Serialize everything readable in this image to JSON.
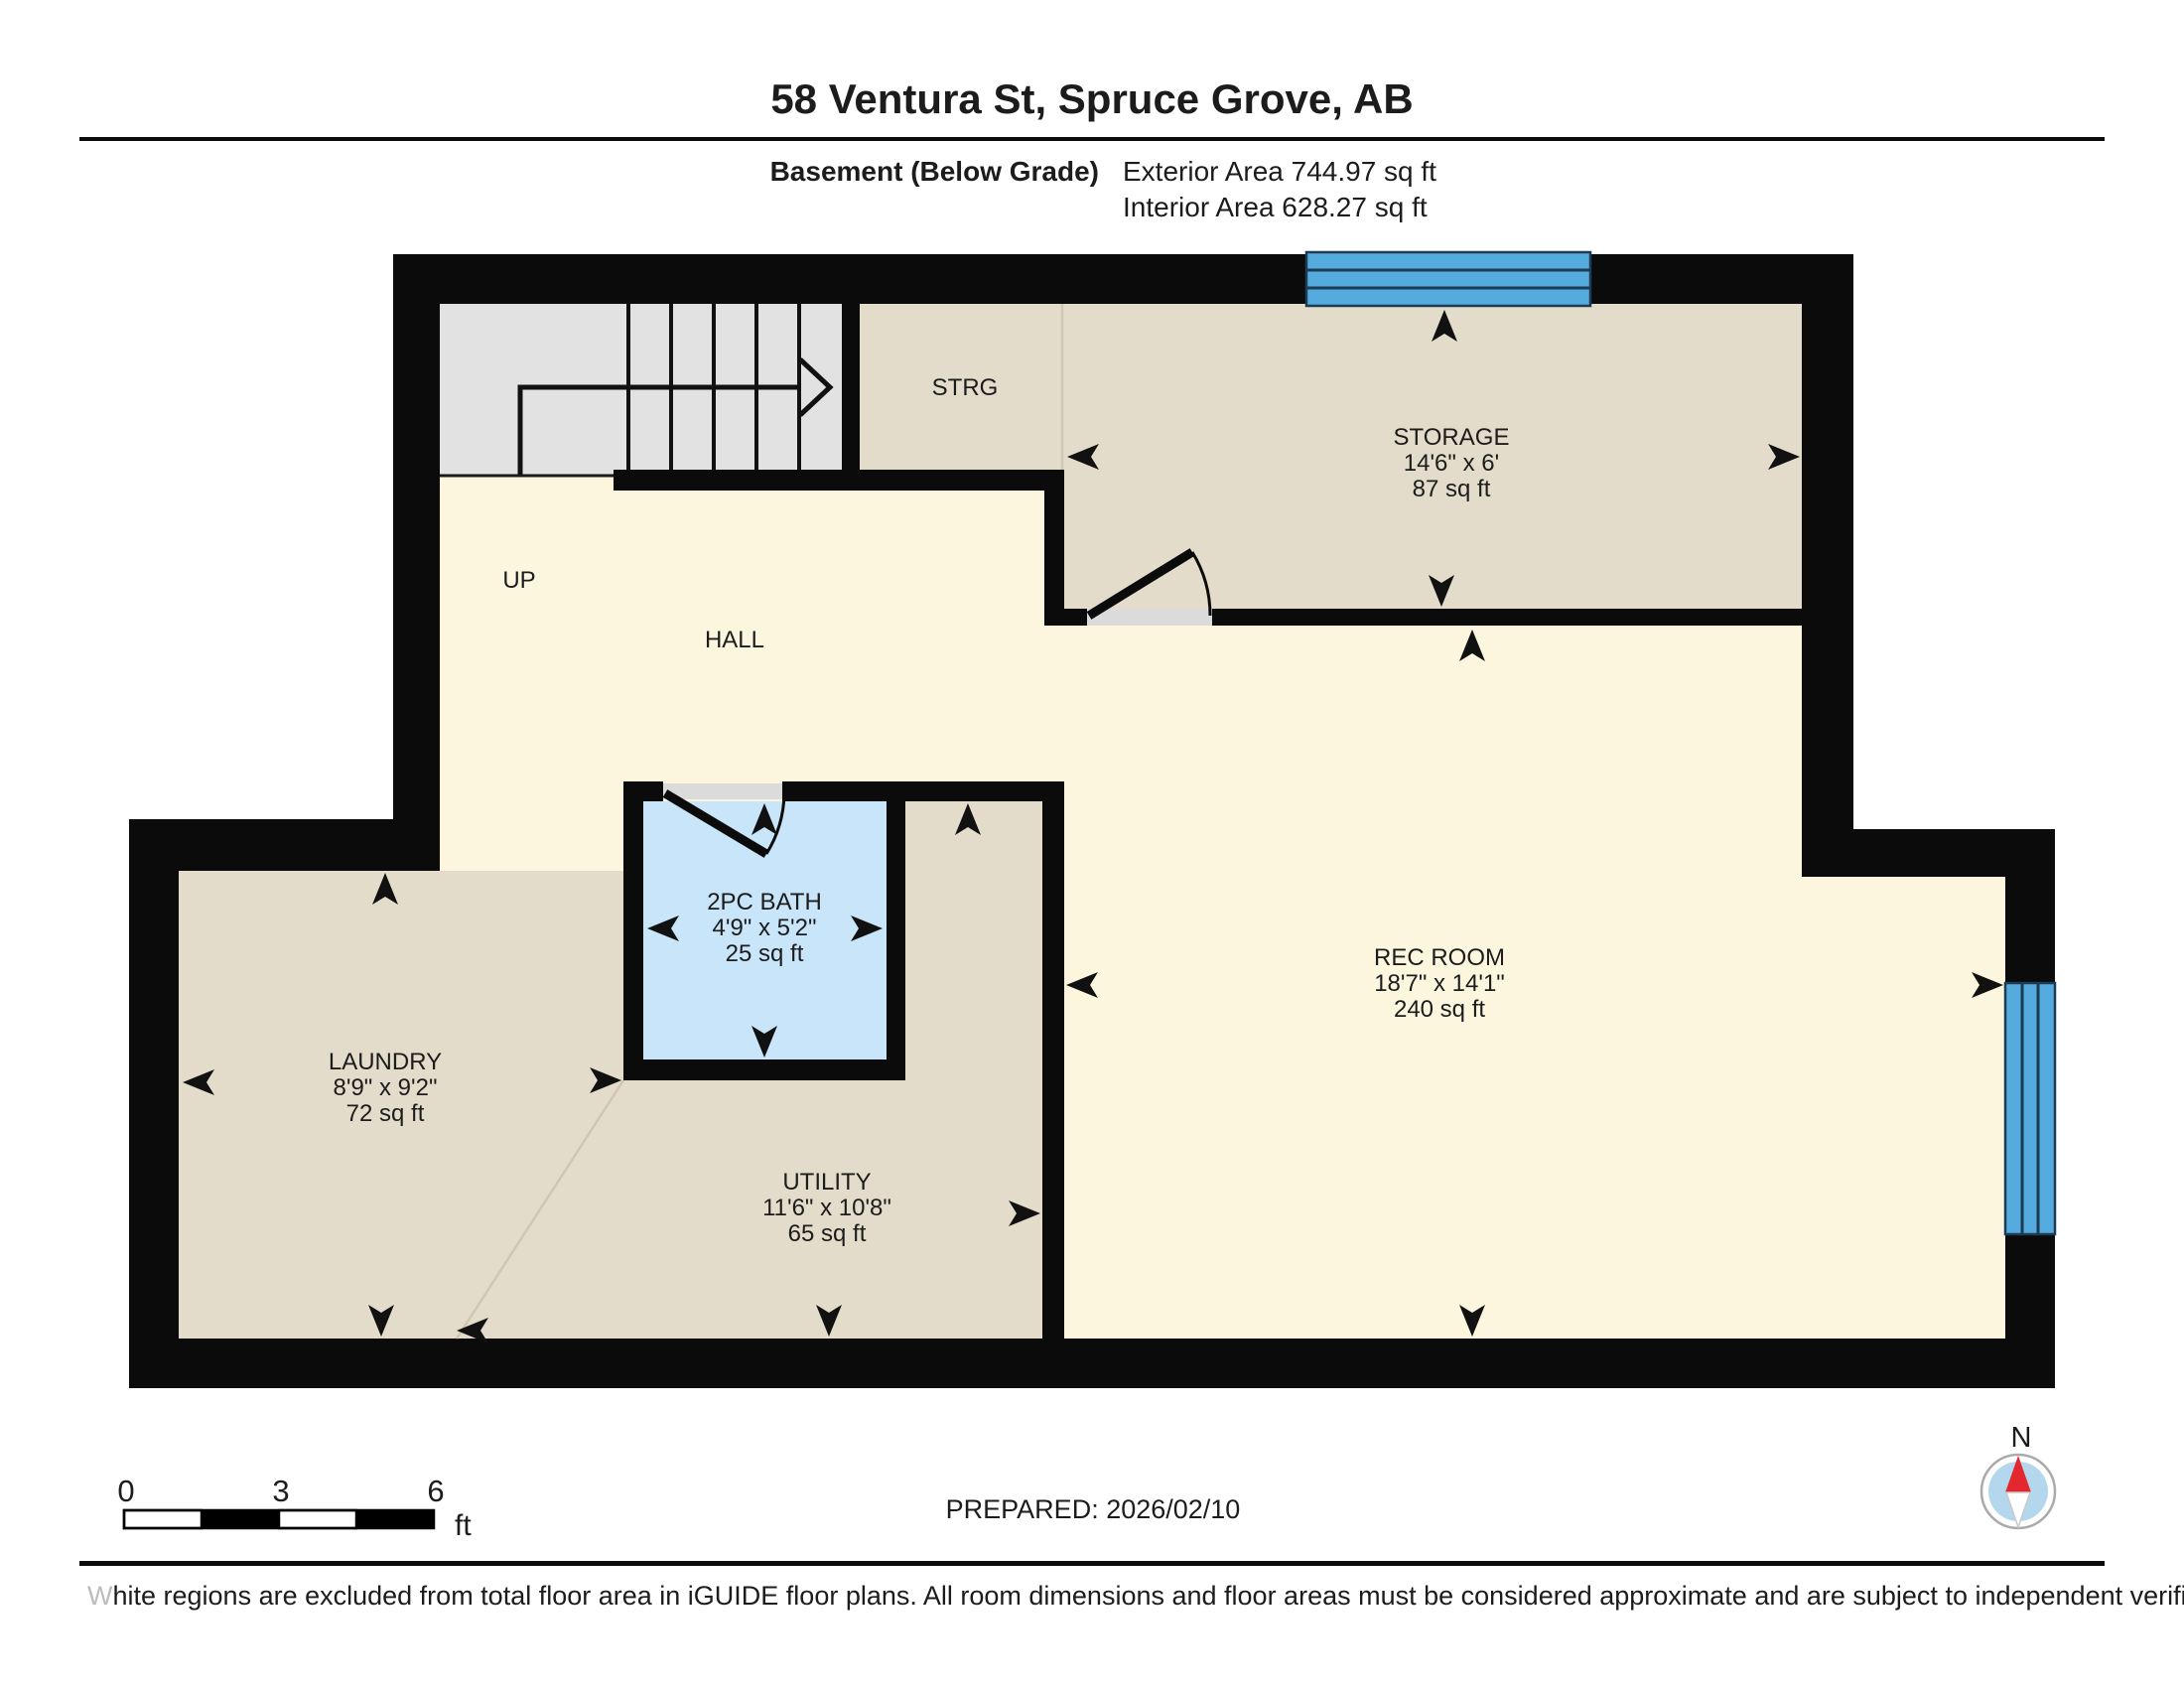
{
  "header": {
    "title": "58 Ventura St, Spruce Grove, AB",
    "floor_label": "Basement (Below Grade)",
    "exterior_area": "Exterior Area 744.97 sq ft",
    "interior_area": "Interior Area 628.27 sq ft"
  },
  "rooms": {
    "storage": {
      "name": "STORAGE",
      "dims": "14'6\" x 6'",
      "area": "87 sq ft"
    },
    "bath": {
      "name": "2PC BATH",
      "dims": "4'9\" x 5'2\"",
      "area": "25 sq ft"
    },
    "laundry": {
      "name": "LAUNDRY",
      "dims": "8'9\" x 9'2\"",
      "area": "72 sq ft"
    },
    "utility": {
      "name": "UTILITY",
      "dims": "11'6\" x 10'8\"",
      "area": "65 sq ft"
    },
    "rec_room": {
      "name": "REC ROOM",
      "dims": "18'7\" x 14'1\"",
      "area": "240 sq ft"
    },
    "strg": {
      "name": "STRG"
    },
    "hall": {
      "name": "HALL"
    }
  },
  "stairs": {
    "direction_label": "UP"
  },
  "scale_bar": {
    "tick_0": "0",
    "tick_3": "3",
    "tick_6": "6",
    "unit": "ft"
  },
  "prepared": {
    "label": "PREPARED: 2026/02/10"
  },
  "compass": {
    "north_label": "N"
  },
  "footer": {
    "disclaimer_first_letter": "W",
    "disclaimer_rest": "hite regions are excluded from total floor area in iGUIDE floor plans. All room dimensions and floor areas must be considered approximate and are subject to independent verification."
  },
  "colors": {
    "wall": "#0b0b0b",
    "open_area_fill": "#fdf6de",
    "excluded_room_fill": "#e4dcca",
    "bathroom_fill": "#c8e5fa",
    "stairs_fill": "#e2e2e2",
    "window_fill": "#55abdd",
    "threshold_fill": "#dbdbdb",
    "compass_needle_red": "#e4262e",
    "compass_face": "#b3d8ee"
  }
}
